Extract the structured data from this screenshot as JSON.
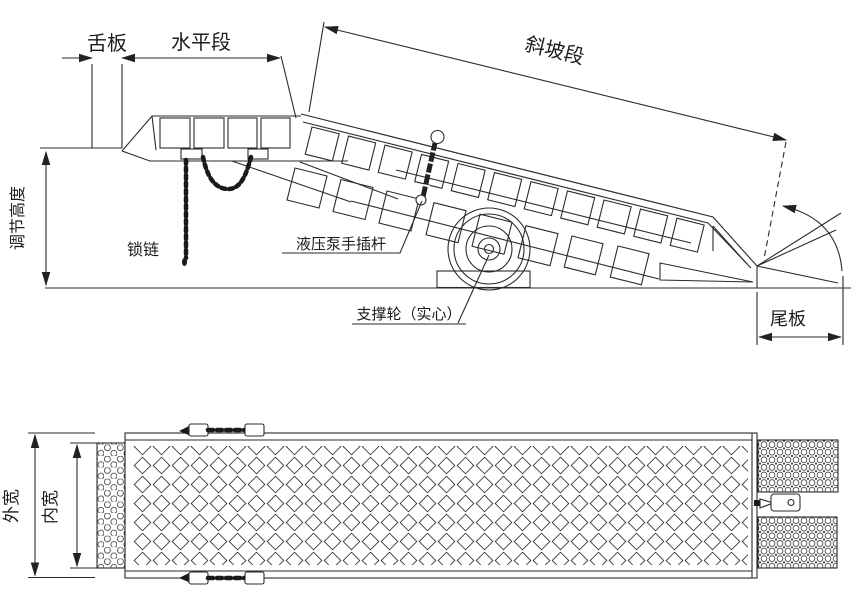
{
  "drawing": {
    "type": "engineering-diagram",
    "subject": "mobile-yard-ramp",
    "colors": {
      "line": "#2b2b2b",
      "background": "#ffffff",
      "arrow": "#222222"
    },
    "side_view": {
      "labels": {
        "tongue_plate": "舌板",
        "horizontal_section": "水平段",
        "slope_section": "斜坡段",
        "adjust_height": "调节高度",
        "lock_chain": "锁链",
        "pump_rod": "液压泵手插杆",
        "support_wheel": "支撑轮（实心）",
        "tail_plate": "尾板"
      }
    },
    "plan_view": {
      "labels": {
        "outer_width": "外宽",
        "inner_width": "内宽"
      }
    }
  }
}
